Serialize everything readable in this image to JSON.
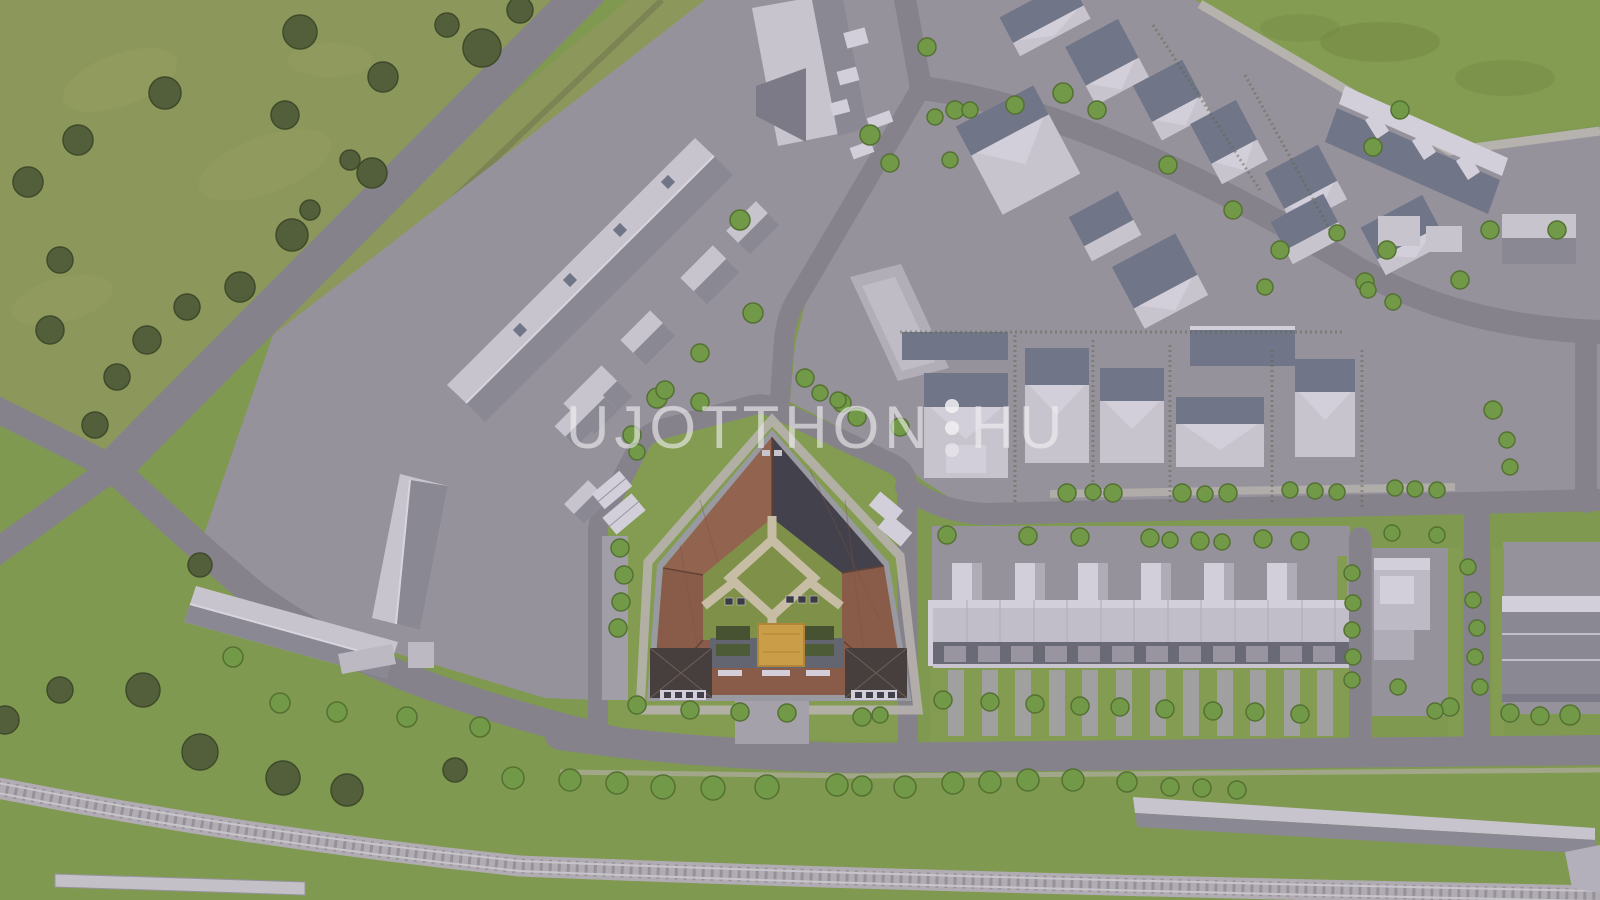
{
  "image": {
    "type": "aerial-3d-architectural-rendering",
    "description": "Bird's-eye 3D visualization of a residential development: a pentagon-shaped courtyard apartment building with brown tiled roofs, green courtyard, playground, surrounded by streets, gray neighborhood buildings, terraced houses, green fields, tree rows and a railway line"
  },
  "watermark": {
    "text_left": "UJOTTHON",
    "text_right": "HU",
    "separator_dots": 3,
    "color": "#ffffff",
    "opacity": 0.6
  },
  "palette": {
    "field_green": "#8d9b55",
    "lawn_green": "#7f9c4a",
    "bright_lawn": "#83a04b",
    "road_gray": "#85838c",
    "pavement_gray": "#98959d",
    "sidewalk": "#bcb8b0",
    "building_wall": "#cfccd5",
    "building_roof_gray": "#8b8994",
    "building_roof_blue": "#6e7487",
    "central_roof_brown": "#8a5942",
    "central_roof_dark": "#3b3c44",
    "central_facade": "#5f626e",
    "courtyard_green": "#7e9440",
    "courtyard_path": "#cfc5a8",
    "playground_sand": "#d2a140",
    "tree_dark": "#4c5c30",
    "tree_bright": "#6f9c3f",
    "railway": "#b6b2b7"
  }
}
